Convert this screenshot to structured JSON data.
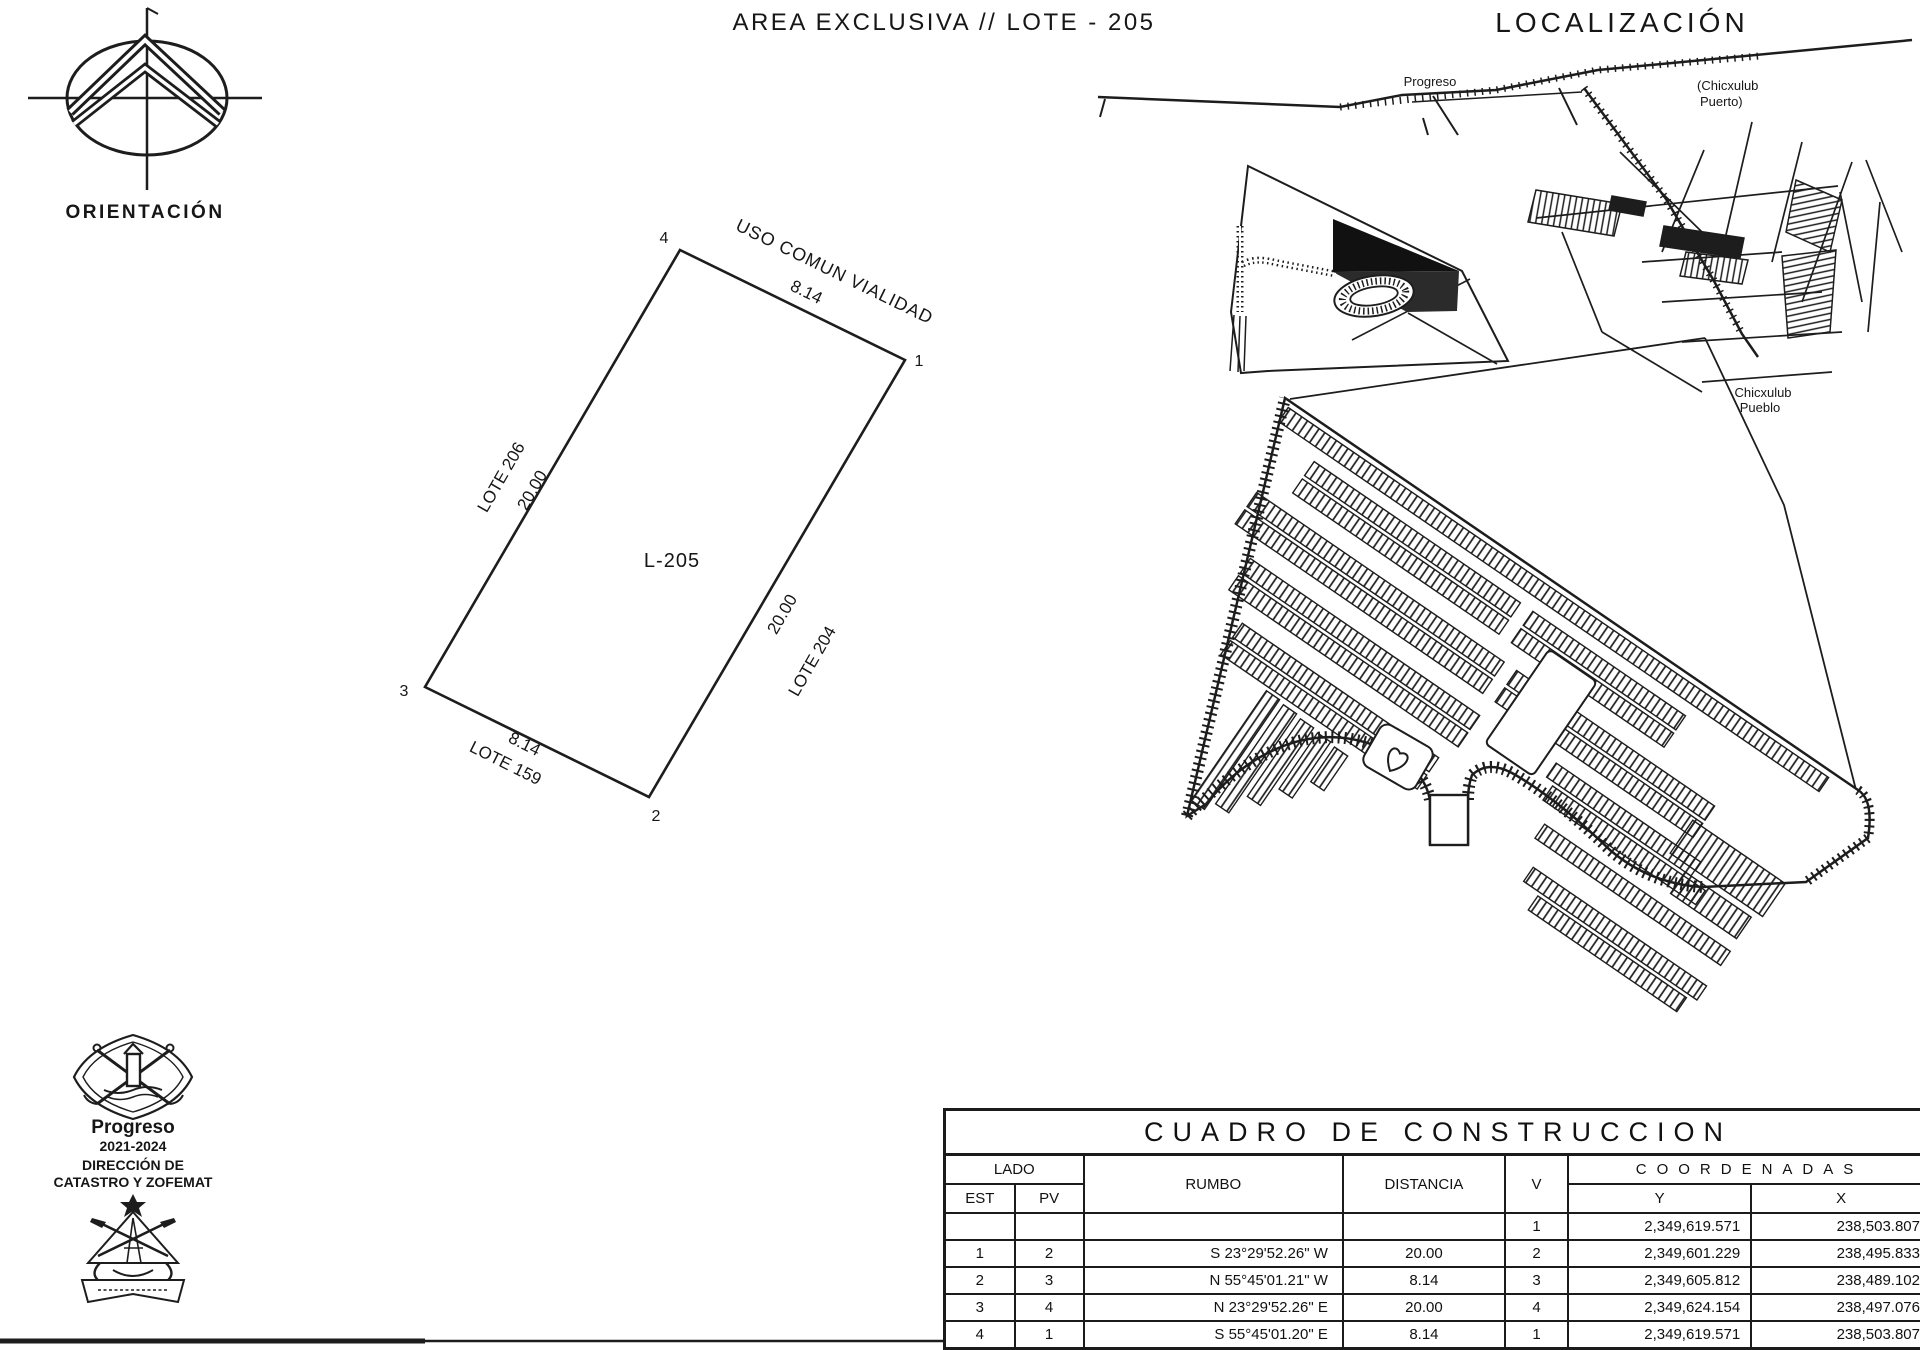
{
  "title": "AREA EXCLUSIVA // LOTE - 205",
  "orientation": {
    "label": "ORIENTACIÓN"
  },
  "localization": {
    "heading": "LOCALIZACIÓN",
    "progreso": "Progreso",
    "puerto_line1": "(Chicxulub",
    "puerto_line2": "Puerto)",
    "pueblo_line1": "Chicxulub",
    "pueblo_line2": "Pueblo"
  },
  "lot": {
    "name": "L-205",
    "north_neighbor": "USO COMUN VIALIDAD",
    "north_dim": "8.14",
    "west_neighbor": "LOTE 206",
    "west_dim": "20.00",
    "east_dim": "20.00",
    "east_neighbor": "LOTE 204",
    "south_dim": "8.14",
    "south_neighbor": "LOTE 159",
    "v1": "1",
    "v2": "2",
    "v3": "3",
    "v4": "4"
  },
  "agency": {
    "city": "Progreso",
    "period": "2021-2024",
    "dept_line1": "DIRECCIÓN DE",
    "dept_line2": "CATASTRO Y ZOFEMAT"
  },
  "table": {
    "title": "CUADRO DE CONSTRUCCION",
    "headers": {
      "lado": "LADO",
      "est": "EST",
      "pv": "PV",
      "rumbo": "RUMBO",
      "distancia": "DISTANCIA",
      "v": "V",
      "coordenadas": "COORDENADAS",
      "y": "Y",
      "x": "X"
    },
    "rows": [
      {
        "est": "",
        "pv": "",
        "rumbo": "",
        "distancia": "",
        "v": "1",
        "y": "2,349,619.571",
        "x": "238,503.807"
      },
      {
        "est": "1",
        "pv": "2",
        "rumbo": "S 23°29'52.26\" W",
        "distancia": "20.00",
        "v": "2",
        "y": "2,349,601.229",
        "x": "238,495.833"
      },
      {
        "est": "2",
        "pv": "3",
        "rumbo": "N 55°45'01.21\" W",
        "distancia": "8.14",
        "v": "3",
        "y": "2,349,605.812",
        "x": "238,489.102"
      },
      {
        "est": "3",
        "pv": "4",
        "rumbo": "N 23°29'52.26\" E",
        "distancia": "20.00",
        "v": "4",
        "y": "2,349,624.154",
        "x": "238,497.076"
      },
      {
        "est": "4",
        "pv": "1",
        "rumbo": "S 55°45'01.20\" E",
        "distancia": "8.14",
        "v": "1",
        "y": "2,349,619.571",
        "x": "238,503.807"
      }
    ]
  },
  "colors": {
    "ink": "#1d1d1d",
    "paper": "#ffffff"
  }
}
